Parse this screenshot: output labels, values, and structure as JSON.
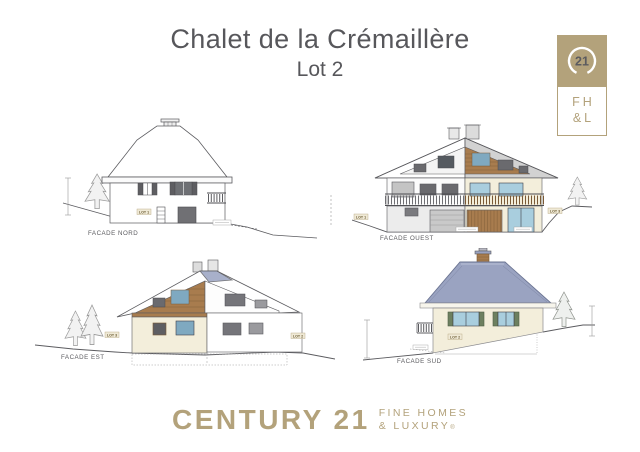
{
  "title": {
    "line1": "Chalet de la Crémaillère",
    "line2": "Lot 2"
  },
  "brand": {
    "seal_number": "21",
    "monogram_line1": "FH",
    "monogram_line2": "&L",
    "wordmark": "CENTURY 21",
    "tagline_line1": "FINE HOMES",
    "tagline_line2": "& LUXURY",
    "registered_mark": "®"
  },
  "facades": {
    "nord": {
      "label": "FACADE NORD",
      "lot_label": "LOT 1"
    },
    "ouest": {
      "label": "FACADE OUEST",
      "lot_label_left": "LOT 1",
      "lot_label_right": "LOT 3"
    },
    "est": {
      "label": "FACADE EST",
      "lot_label_left": "LOT 3",
      "lot_label_right": "LOT 2"
    },
    "sud": {
      "label": "FACADE SUD",
      "lot_label": "LOT 2"
    }
  },
  "colors": {
    "brand_gold": "#b3a27b",
    "ink": "#5b5b5f",
    "wood": "#a87c4e",
    "wood_dark": "#7a5a36",
    "cream": "#f3eedb",
    "roof_blue": "#9aa3c1",
    "glass_blue": "#a9cede",
    "shutter_green": "#6d8060",
    "neutral_gray": "#d2d2d2"
  }
}
